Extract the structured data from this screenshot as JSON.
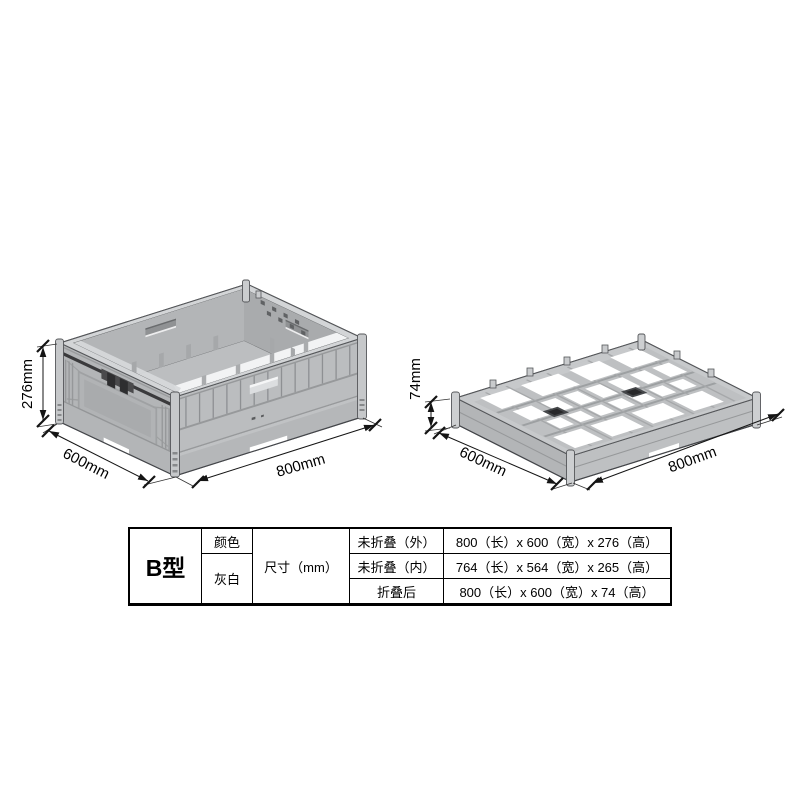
{
  "page": {
    "background": "#ffffff"
  },
  "drawing": {
    "unfolded": {
      "label": "unfolded-crate",
      "dims": {
        "height": "276mm",
        "width": "600mm",
        "length": "800mm"
      }
    },
    "folded": {
      "label": "folded-crate",
      "dims": {
        "height": "74mm",
        "width": "600mm",
        "length": "800mm"
      }
    },
    "colors": {
      "body": "#b8babc",
      "rim": "#d3d5d7",
      "interior": "#b1b3b5",
      "floor": "#bcbec0",
      "highlight": "#f2f3f4",
      "outline": "#44464a",
      "latch": "#3a3a3c",
      "dimension": "#141414"
    }
  },
  "table": {
    "model": "B型",
    "color_label": "颜色",
    "color_value": "灰白",
    "size_label": "尺寸（mm）",
    "rows": [
      {
        "label": "未折叠（外）",
        "value": "800（长）x 600（宽）x 276（高）"
      },
      {
        "label": "未折叠（内）",
        "value": "764（长）x 564（宽）x 265（高）"
      },
      {
        "label": "折叠后",
        "value": "800（长）x 600（宽）x 74（高）"
      }
    ]
  }
}
